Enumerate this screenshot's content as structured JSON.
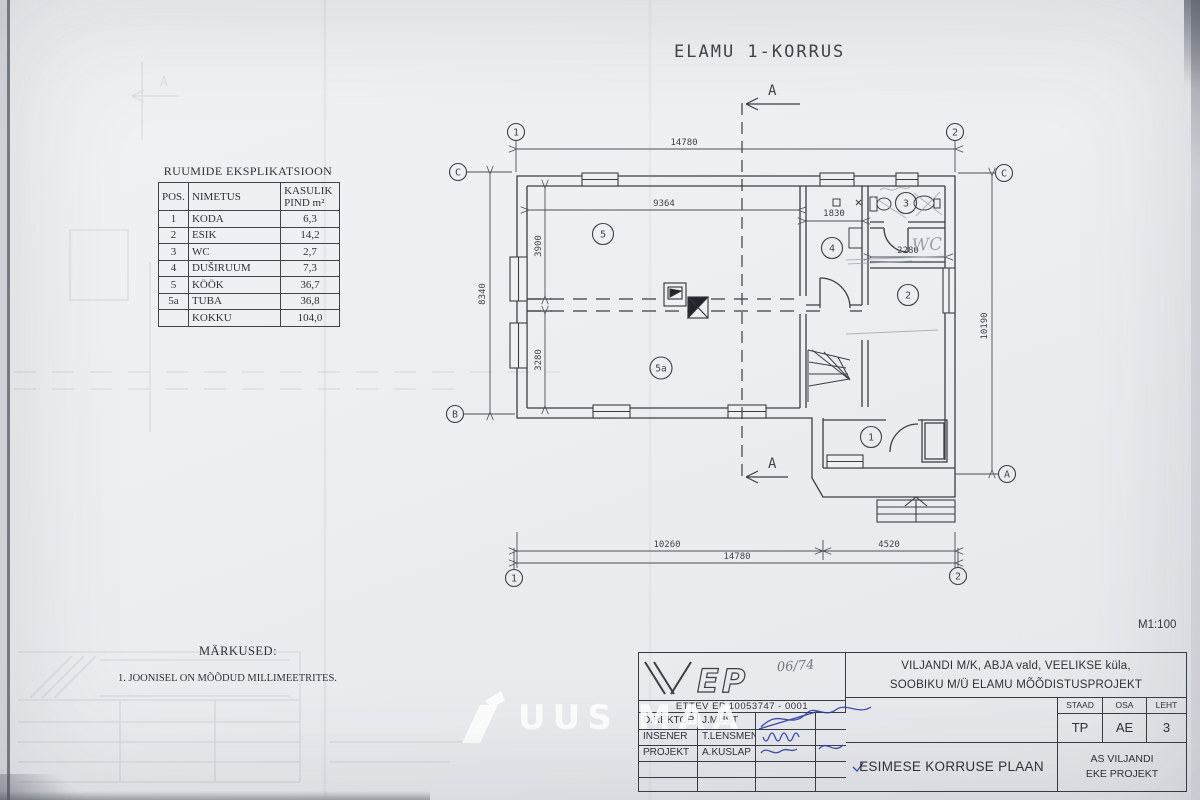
{
  "sheet": {
    "title": "ELAMU 1-KORRUS",
    "scale": "M1:100"
  },
  "explication": {
    "title": "RUUMIDE EKSPLIKATSIOON",
    "col_pos": "POS.",
    "col_name": "NIMETUS",
    "col_area_line1": "KASULIK",
    "col_area_line2": "PIND m²",
    "rows": [
      [
        "1",
        "KODA",
        "6,3"
      ],
      [
        "2",
        "ESIK",
        "14,2"
      ],
      [
        "3",
        "WC",
        "2,7"
      ],
      [
        "4",
        "DUŠIRUUM",
        "7,3"
      ],
      [
        "5",
        "KÖÖK",
        "36,7"
      ],
      [
        "5a",
        "TUBA",
        "36,8"
      ],
      [
        "",
        "KOKKU",
        "104,0"
      ]
    ]
  },
  "notes": {
    "heading": "MÄRKUSED:",
    "item1": "1. JOONISEL ON MÕÕDUD MILLIMEETRITES."
  },
  "plan": {
    "section_top": "A",
    "section_bottom": "A",
    "grid": {
      "top_left": "1",
      "top_right": "2",
      "bottom_left": "1",
      "bottom_right": "2",
      "c_left": "C",
      "c_right": "C",
      "b_left": "B",
      "a_right": "A"
    },
    "rooms": {
      "r1": "1",
      "r2": "2",
      "r3": "3",
      "r4": "4",
      "r5": "5",
      "r5a": "5a"
    },
    "dims": {
      "top_total": "14780",
      "inner_width": "9364",
      "kook_depth": "3900",
      "tuba_depth": "3280",
      "left_height": "8340",
      "right_height": "10190",
      "dush_width": "1830",
      "wc_width": "2280",
      "bottom_left": "10260",
      "bottom_right": "4520",
      "bottom_total": "14780"
    },
    "pencil_note": "WC"
  },
  "title_block": {
    "logo_text": "EP",
    "stamp_number": "06/74",
    "reg_line": "ETTEV EP 10053747 - 0001",
    "rows": [
      {
        "role": "DIREKTOR",
        "name": "J.MUST"
      },
      {
        "role": "INSENER",
        "name": "T.LENSMENT"
      },
      {
        "role": "PROJEKT",
        "name": "A.KUSLAP"
      }
    ],
    "project_line1": "VILJANDI M/K, ABJA vald, VEELIKSE küla,",
    "project_line2": "SOOBIKU M/Ü ELAMU MÕÕDISTUSPROJEKT",
    "staad_label": "STAAD",
    "staad_value": "TP",
    "osa_label": "OSA",
    "osa_value": "AE",
    "leht_label": "LEHT",
    "leht_value": "3",
    "drawing_title": "ESIMESE KORRUSE PLAAN",
    "company_line1": "AS VILJANDI",
    "company_line2": "EKE PROJEKT"
  },
  "watermark": {
    "text": "UUS MAA"
  }
}
